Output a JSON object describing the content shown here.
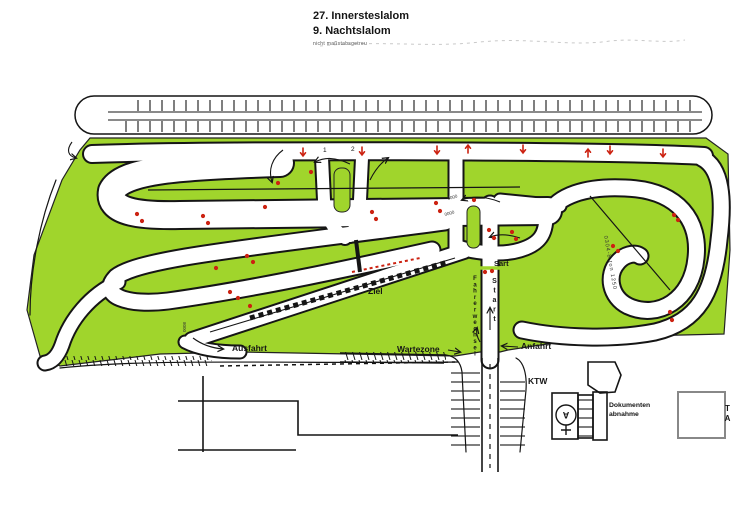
{
  "title": {
    "line1": "27. Innersteslalom",
    "line2": "9. Nachtslalom",
    "note": "nicht maßstabsgetreu"
  },
  "colors": {
    "grass": "#a0d52c",
    "ink": "#151515",
    "marker": "#cc2211",
    "shadow": "#888888"
  },
  "map": {
    "labels": {
      "ausfahrt": "Ausfahrt",
      "wartezone": "Wartezone",
      "anfahrt": "Anfahrt",
      "ziel": "Ziel",
      "sart": "Sart",
      "start": "Start",
      "fahrerwechsel": "Fahrerwechsel",
      "ktw": "KTW",
      "dokumenten1": "Dokumenten",
      "dokumenten2": "abnahme",
      "ta": "TA",
      "gate1": "1",
      "gate2": "2",
      "aid": "A"
    },
    "distance_marks": {
      "m1": "0008",
      "m2": "0000",
      "m3": "0000",
      "m4": "0304-8 ton 1250"
    }
  }
}
